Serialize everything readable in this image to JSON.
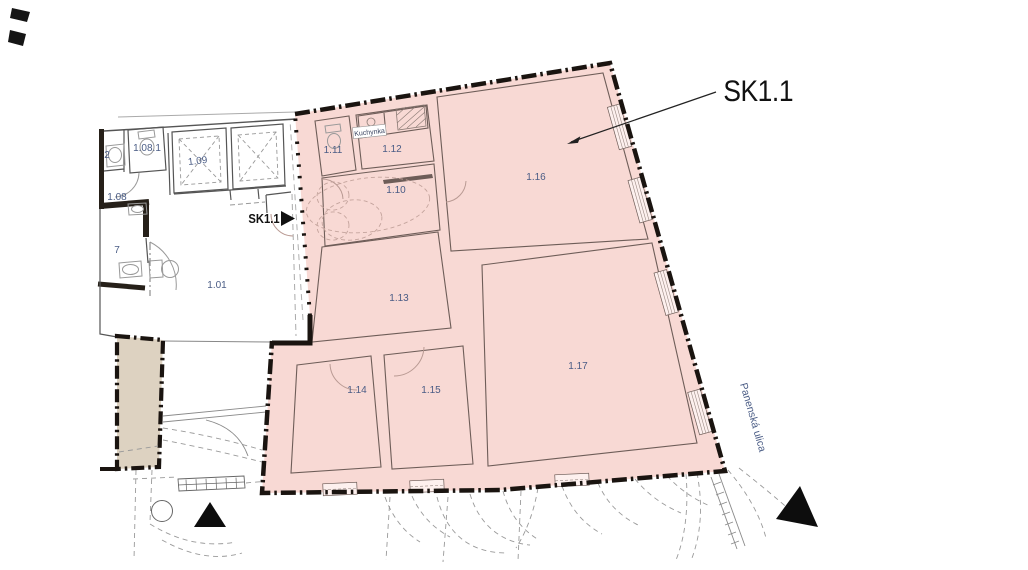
{
  "unit": {
    "callout": "SK1.1",
    "entrance_marker": "SK1.1"
  },
  "street": {
    "name": "Panenská ulica"
  },
  "rooms": {
    "r101": "1.01",
    "r102": "2",
    "r107": "7",
    "r108": "1.08",
    "r1081": "1.08.1",
    "r109": "1.09",
    "r110": "1.10",
    "r111": "1.11",
    "r112": "1.12",
    "r113": "1.13",
    "r114": "1.14",
    "r115": "1.15",
    "r116": "1.16",
    "r117": "1.17",
    "kitchen": "Kuchynka"
  },
  "colors": {
    "unit_fill": "#f8d9d4",
    "adjacent_building_fill": "#ddd2c1",
    "boundary": "#1a1410",
    "room_label": "#4a5c85",
    "interior_wall": "#6e5d58"
  }
}
